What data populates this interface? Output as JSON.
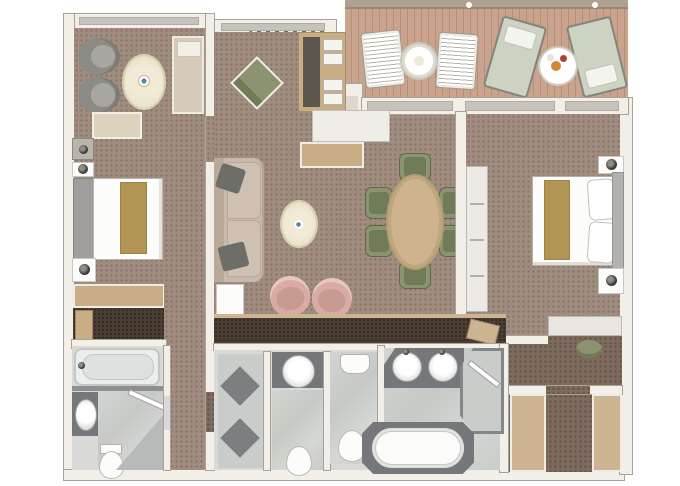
{
  "type": "floor-plan",
  "subject": "two-bedroom suite with private veranda",
  "canvas": {
    "width": 680,
    "height": 486
  },
  "rooms": [
    {
      "id": "veranda",
      "items": [
        "deck-chair",
        "deck-chair",
        "round-lattice-table",
        "sun-lounger",
        "sun-lounger",
        "round-serving-table"
      ]
    },
    {
      "id": "guest-bedroom",
      "items": [
        "armchair",
        "armchair",
        "oval-rug",
        "chaise-lounge",
        "bench",
        "double-bed",
        "nightstand",
        "nightstand",
        "dresser",
        "cabinet"
      ]
    },
    {
      "id": "walk-in-closet",
      "items": [
        "shelving"
      ]
    },
    {
      "id": "guest-bathroom",
      "items": [
        "bathtub",
        "washbasin",
        "toilet",
        "corner-shower"
      ]
    },
    {
      "id": "living-room",
      "items": [
        "sofa",
        "throw-pillow",
        "throw-pillow",
        "end-table",
        "coffee-table",
        "accent-chair",
        "accent-chair",
        "lounge-chair",
        "bar-cabinet",
        "console",
        "sideboard"
      ]
    },
    {
      "id": "dining-area",
      "items": [
        "dining-table",
        "dining-chair",
        "dining-chair",
        "dining-chair",
        "dining-chair",
        "dining-chair",
        "dining-chair"
      ]
    },
    {
      "id": "master-bedroom",
      "items": [
        "double-bed",
        "pillow",
        "pillow",
        "nightstand",
        "nightstand",
        "wardrobe",
        "vanity-desk",
        "vanity-stool"
      ]
    },
    {
      "id": "dressing-corridor",
      "items": []
    },
    {
      "id": "master-bathroom",
      "items": [
        "double-washbasin",
        "oval-bathtub",
        "walk-in-shower",
        "toilet",
        "bidet",
        "tiled-room"
      ]
    },
    {
      "id": "entry-hall",
      "items": [
        "closet",
        "closet"
      ]
    }
  ],
  "palette": {
    "carpet": "#a18d80",
    "carpet-dark": "#7e6b5f",
    "closet-floor": "#4b3d33",
    "deck": "#c9a38c",
    "deck-line": "#b68f79",
    "wall": "#f2efe9",
    "wall-edge": "#a8a29a",
    "tile": "#d9dad7",
    "tile2": "#c9ccc9",
    "marble": "#cdd0cd",
    "fix-dark": "#75777b",
    "white": "#fcfcfb",
    "wood": "#c9ae85",
    "gold": "#b29555",
    "sofa": "#c8b9aa",
    "grey-chair": "#8c8c86",
    "pink": "#d8aba4",
    "green": "#8b9371",
    "green-dark": "#707b58",
    "cream": "#e9e2cb",
    "tan": "#cdb493"
  }
}
